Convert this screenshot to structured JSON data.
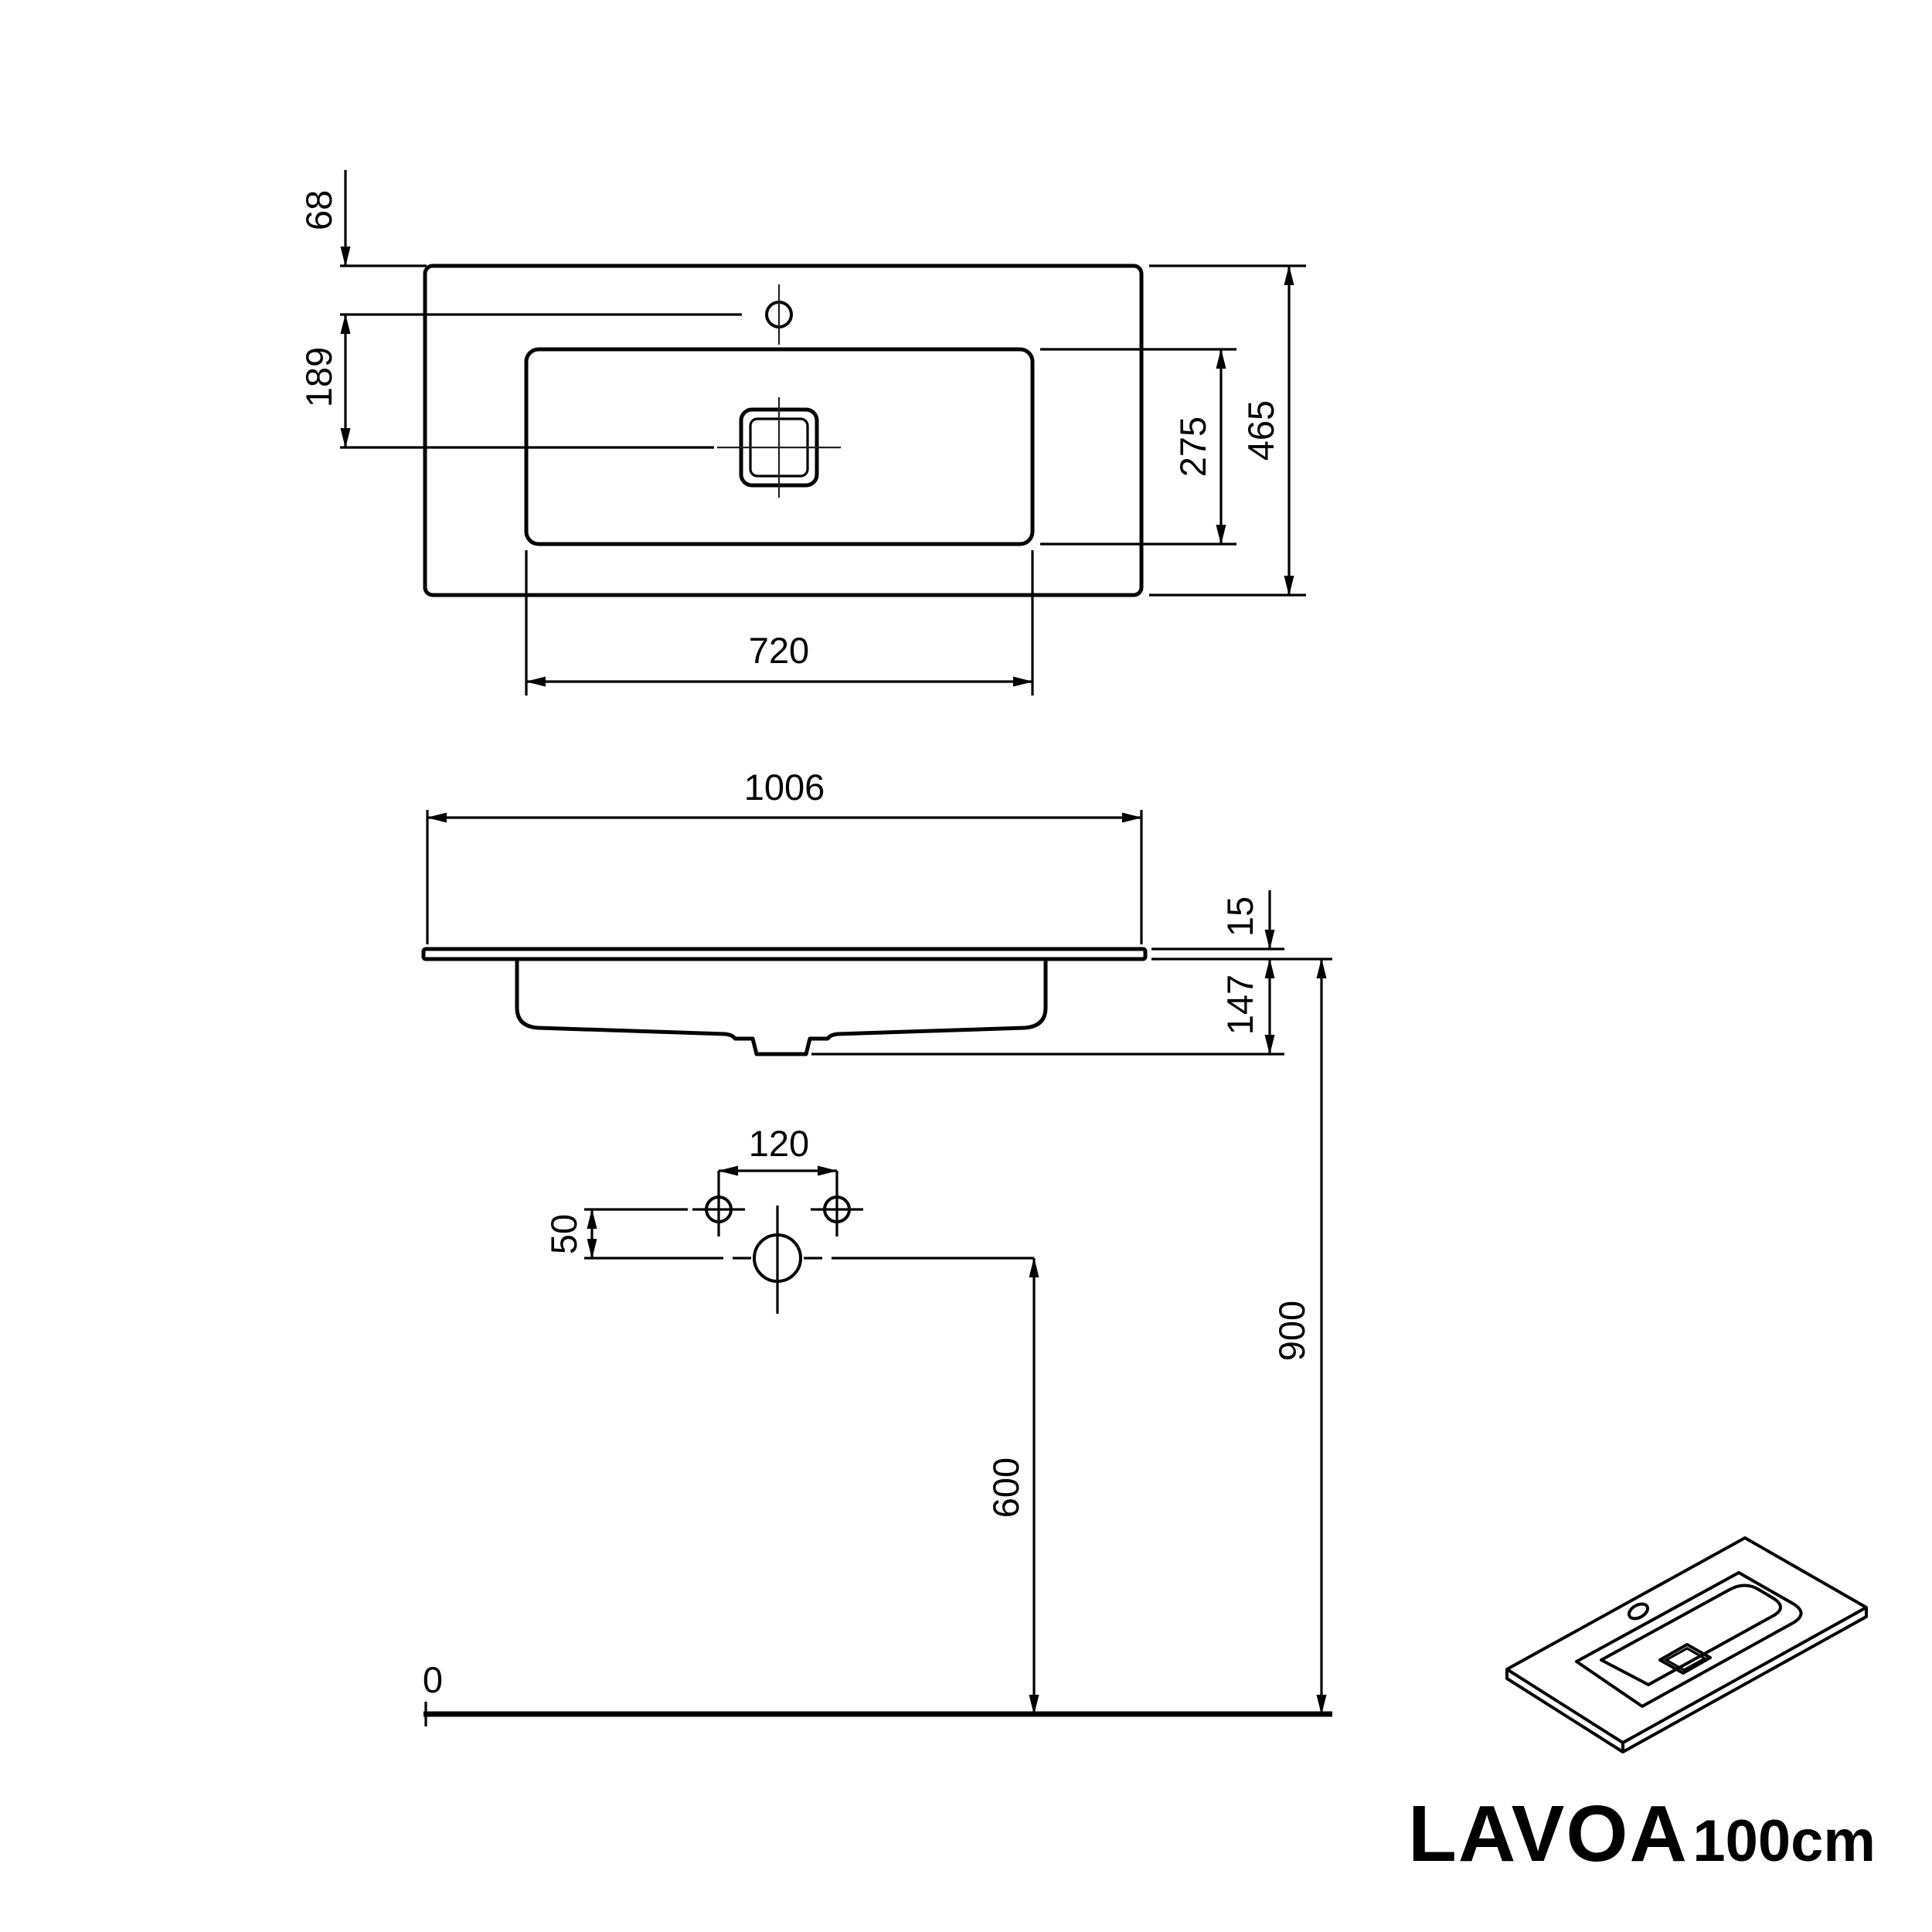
{
  "product": {
    "name": "LAVOA",
    "variant": "100cm"
  },
  "colors": {
    "line": "#000000",
    "background": "#ffffff"
  },
  "top_view": {
    "faucet_hole_offset_mm": "68",
    "faucet_to_drain_mm": "189",
    "basin_cutout_width_mm": "720",
    "basin_cutout_depth_mm": "275",
    "overall_depth_mm": "465"
  },
  "front_view": {
    "overall_width_mm": "1006",
    "top_edge_thickness_mm": "15",
    "bowl_depth_mm": "147"
  },
  "installation_view": {
    "fixing_hole_spacing_mm": "120",
    "fixing_hole_offset_mm": "50",
    "drain_height_mm": "600",
    "mounting_height_mm": "900",
    "floor_level": "0"
  }
}
